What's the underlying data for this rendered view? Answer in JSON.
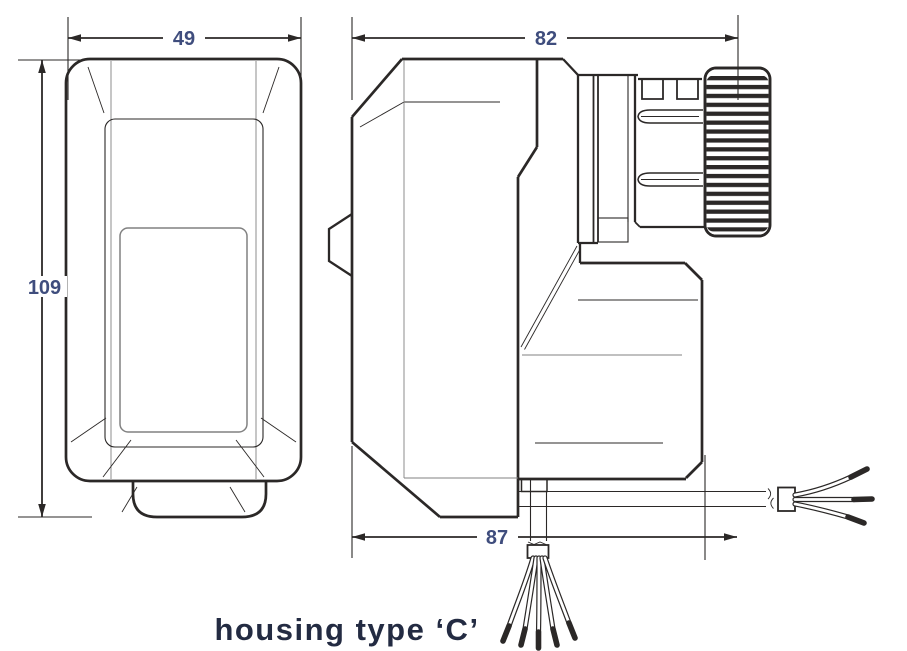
{
  "caption": "housing type ‘C’",
  "dims": {
    "front_width": "49",
    "front_height": "109",
    "side_depth_upper": "82",
    "side_depth_lower": "87"
  },
  "colors": {
    "line": "#2b2827",
    "gray_line": "#818181",
    "dim_text": "#3f4d7d",
    "caption_text": "#232b42",
    "background": "#ffffff"
  }
}
